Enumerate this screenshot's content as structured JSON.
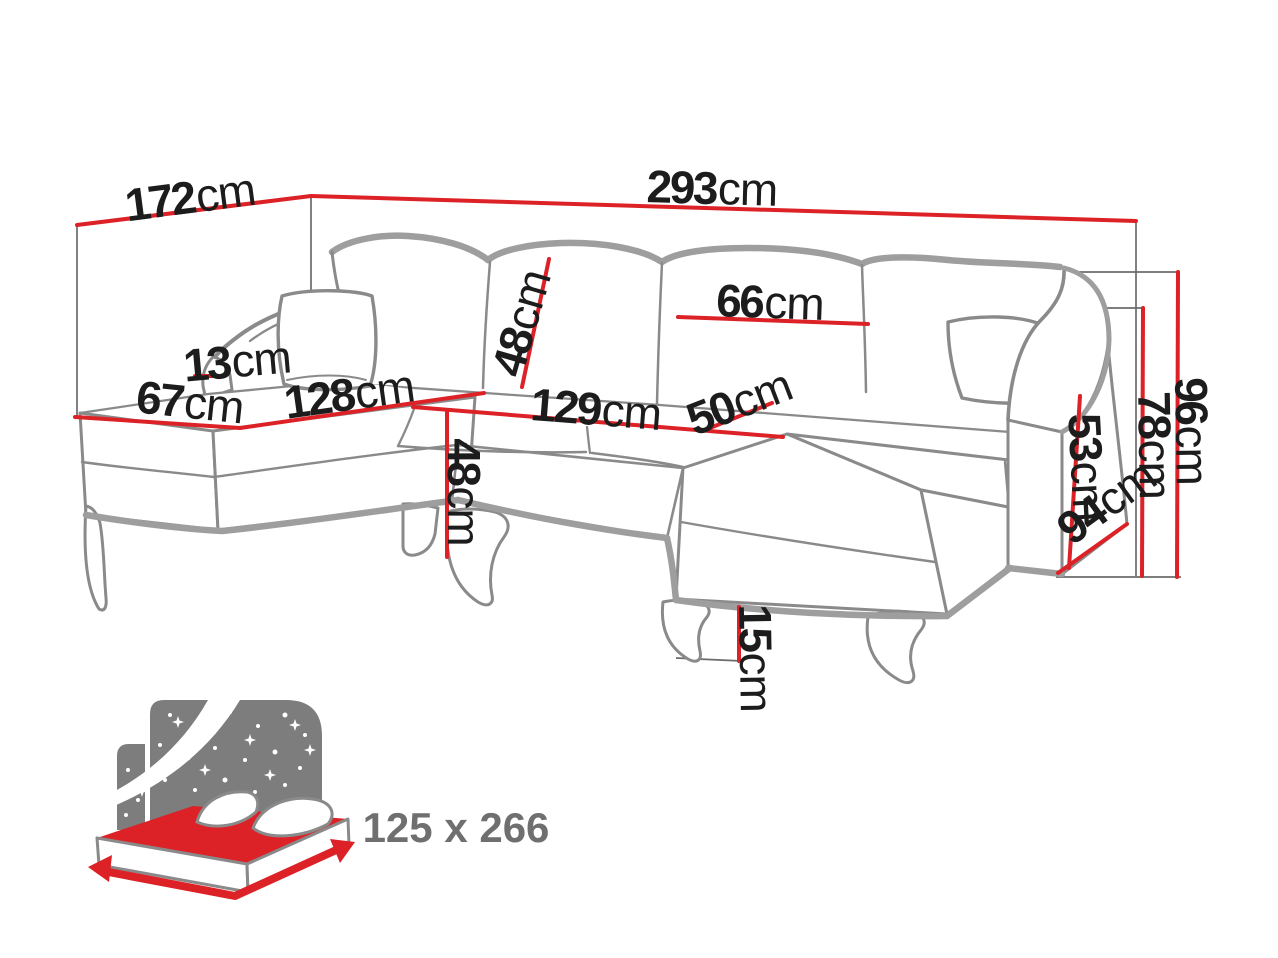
{
  "diagram": {
    "description": "U-shaped corner sofa bed dimension diagram",
    "unit": "cm",
    "dimensions": {
      "total_depth": {
        "num": "172",
        "unit": "cm"
      },
      "total_width": {
        "num": "293",
        "unit": "cm"
      },
      "left_arm_width": {
        "num": "13",
        "unit": "cm"
      },
      "left_chaise_width": {
        "num": "67",
        "unit": "cm"
      },
      "left_chaise_length": {
        "num": "128",
        "unit": "cm"
      },
      "backrest_height": {
        "num": "48",
        "unit": "cm"
      },
      "back_cushion_width": {
        "num": "66",
        "unit": "cm"
      },
      "seat_length": {
        "num": "129",
        "unit": "cm"
      },
      "seat_depth": {
        "num": "50",
        "unit": "cm"
      },
      "seat_height": {
        "num": "48",
        "unit": "cm"
      },
      "armrest_height": {
        "num": "53",
        "unit": "cm"
      },
      "arm_outer_height": {
        "num": "78",
        "unit": "cm"
      },
      "total_height": {
        "num": "96",
        "unit": "cm"
      },
      "right_chaise_depth": {
        "num": "94",
        "unit": "cm"
      },
      "leg_height": {
        "num": "15",
        "unit": "cm"
      }
    },
    "sleeping_area": {
      "label": "125 x 266"
    }
  },
  "colors": {
    "dimension_red": "#dc2127",
    "outline_gray": "#8a8a8a",
    "shadow_gray": "#9e9e9e",
    "guide_gray": "#6b6b6b",
    "label_black": "#1c1c1c",
    "muted_gray": "#6f6f6f",
    "icon_gray": "#7d7d7d"
  }
}
